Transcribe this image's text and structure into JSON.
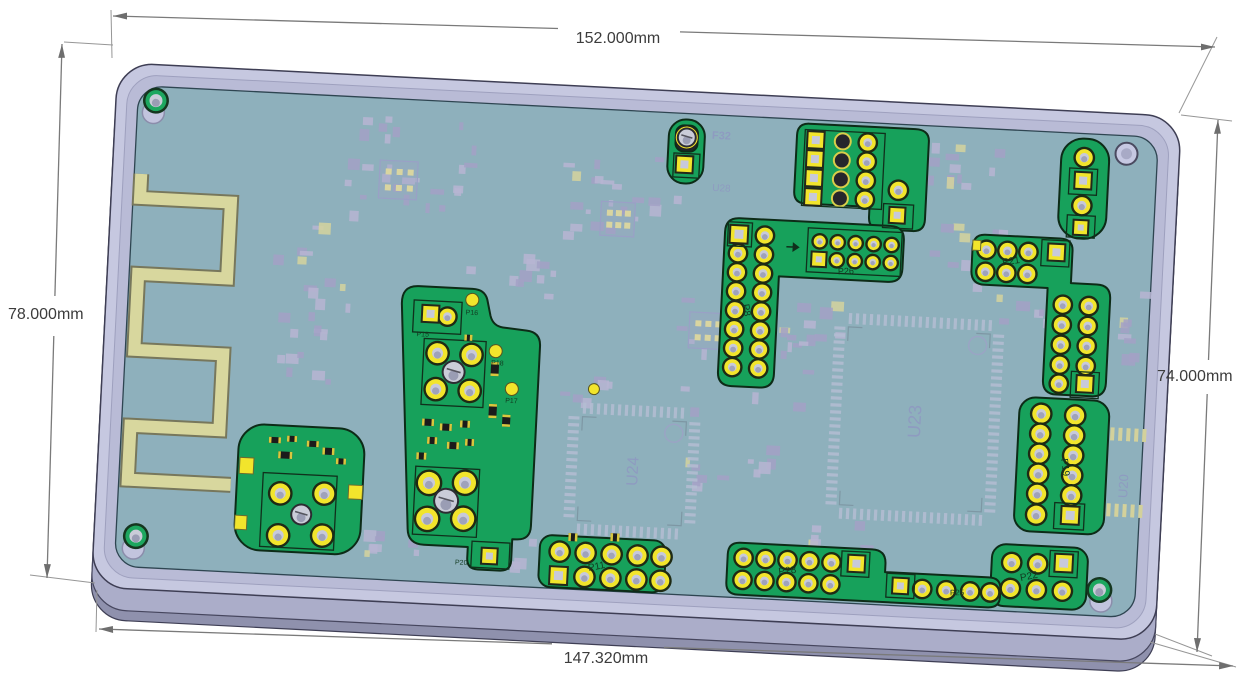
{
  "scene": {
    "description": "3D CAD render of PCB assembly mounted on base plate with dimensions",
    "background": "#ffffff"
  },
  "dimensions": {
    "top": {
      "label": "152.000mm"
    },
    "left": {
      "label": "78.000mm"
    },
    "right": {
      "label": "74.000mm"
    },
    "bottom": {
      "label": "147.320mm"
    }
  },
  "colors": {
    "plate": "#c6c8e0",
    "plate_side": "#abadc9",
    "plate_recess": "#b9bbd6",
    "pcb": "#8eb0bc",
    "highlight_green": "#17a15b",
    "pad_yellow": "#f2e52c",
    "antenna": "#d8d79e",
    "silkscreen": "#a8a6c8",
    "dimension_line": "#7a7a7a"
  },
  "refs": {
    "p8": "P8",
    "p11": "P11",
    "p15": "P15",
    "p16": "P16",
    "p17": "P17",
    "p18": "P18",
    "p19": "P19",
    "p20": "P20",
    "p21": "P21",
    "p22": "P22",
    "p25": "P25",
    "p26": "P26",
    "p28": "P28",
    "u20": "U20",
    "u23": "U23",
    "u24": "U24",
    "u28": "U28",
    "f32": "F32"
  }
}
